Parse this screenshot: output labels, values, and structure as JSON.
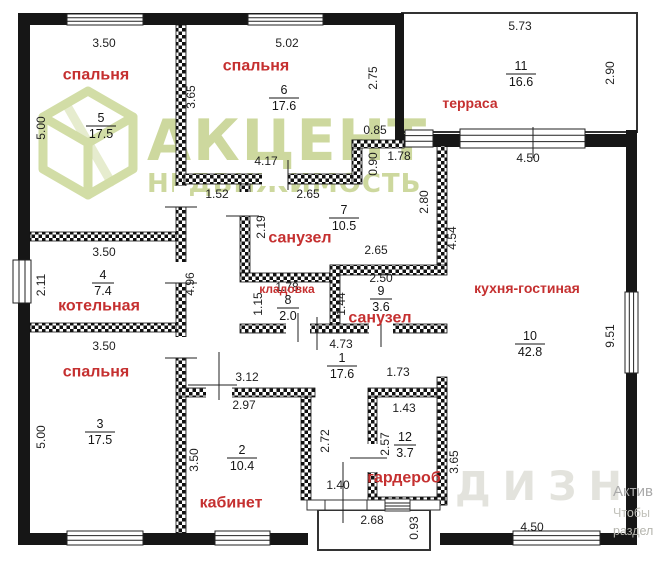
{
  "watermark": {
    "brand": "АКЦЕНТ",
    "subtitle": "НЕДВИЖИМОСТЬ",
    "faint": "ДИЗН",
    "brand_color": "#cdd89e"
  },
  "corner_note": {
    "line1": "Актив",
    "line2": "Чтобы",
    "line3": "раздел"
  },
  "accent_colors": {
    "room_label_red": "#c53030",
    "wall_black": "#161616"
  },
  "rooms": [
    {
      "n": "1",
      "a": "17.6",
      "nx": 342,
      "ny": 358
    },
    {
      "n": "2",
      "a": "10.4",
      "nx": 242,
      "ny": 450,
      "label": "кабинет",
      "lx": 231,
      "ly": 503
    },
    {
      "n": "3",
      "a": "17.5",
      "nx": 100,
      "ny": 424,
      "label": "спальня",
      "lx": 96,
      "ly": 372
    },
    {
      "n": "4",
      "a": "7.4",
      "nx": 103,
      "ny": 275,
      "label": "котельная",
      "lx": 99,
      "ly": 306
    },
    {
      "n": "5",
      "a": "17.5",
      "nx": 101,
      "ny": 118,
      "label": "спальня",
      "lx": 96,
      "ly": 75
    },
    {
      "n": "6",
      "a": "17.6",
      "nx": 284,
      "ny": 90,
      "label": "спальня",
      "lx": 256,
      "ly": 66
    },
    {
      "n": "7",
      "a": "10.5",
      "nx": 344,
      "ny": 210,
      "label": "санузел",
      "lx": 300,
      "ly": 238
    },
    {
      "n": "8",
      "a": "2.0",
      "nx": 288,
      "ny": 300,
      "label": "кладовка",
      "lx": 287,
      "ly": 289,
      "fs": 12
    },
    {
      "n": "9",
      "a": "3.6",
      "nx": 381,
      "ny": 291,
      "label": "санузел",
      "lx": 380,
      "ly": 318
    },
    {
      "n": "10",
      "a": "42.8",
      "nx": 530,
      "ny": 336,
      "label": "кухня-гостиная",
      "lx": 527,
      "ly": 288,
      "fs": 14
    },
    {
      "n": "11",
      "a": "16.6",
      "nx": 521,
      "ny": 66,
      "label": "терраса",
      "lx": 470,
      "ly": 103,
      "fs": 14
    },
    {
      "n": "12",
      "a": "3.7",
      "nx": 405,
      "ny": 437,
      "label": "гардероб",
      "lx": 404,
      "ly": 478
    }
  ],
  "dimensions": [
    {
      "t": "3.50",
      "x": 104,
      "y": 43
    },
    {
      "t": "5.02",
      "x": 287,
      "y": 43
    },
    {
      "t": "5.73",
      "x": 520,
      "y": 26
    },
    {
      "t": "2.75",
      "x": 373,
      "y": 78,
      "r": 1
    },
    {
      "t": "2.90",
      "x": 610,
      "y": 73,
      "r": 1
    },
    {
      "t": "3.65",
      "x": 191,
      "y": 97,
      "r": 1
    },
    {
      "t": "5.00",
      "x": 41,
      "y": 128,
      "r": 1
    },
    {
      "t": "0.85",
      "x": 375,
      "y": 130
    },
    {
      "t": "4.17",
      "x": 266,
      "y": 161
    },
    {
      "t": "1.78",
      "x": 399,
      "y": 156
    },
    {
      "t": "0.90",
      "x": 373,
      "y": 164,
      "r": 1
    },
    {
      "t": "4.50",
      "x": 528,
      "y": 158
    },
    {
      "t": "1.52",
      "x": 217,
      "y": 194
    },
    {
      "t": "2.65",
      "x": 308,
      "y": 194
    },
    {
      "t": "2.80",
      "x": 424,
      "y": 202,
      "r": 1
    },
    {
      "t": "2.19",
      "x": 261,
      "y": 227,
      "r": 1
    },
    {
      "t": "4.54",
      "x": 452,
      "y": 238,
      "r": 1
    },
    {
      "t": "2.65",
      "x": 376,
      "y": 250
    },
    {
      "t": "3.50",
      "x": 104,
      "y": 252
    },
    {
      "t": "2.50",
      "x": 381,
      "y": 278
    },
    {
      "t": "2.11",
      "x": 41,
      "y": 285,
      "r": 1
    },
    {
      "t": "4.96",
      "x": 190,
      "y": 284,
      "r": 1
    },
    {
      "t": "1.78",
      "x": 287,
      "y": 287
    },
    {
      "t": "1.15",
      "x": 258,
      "y": 304,
      "r": 1
    },
    {
      "t": "1.44",
      "x": 341,
      "y": 304,
      "r": 1
    },
    {
      "t": "9.51",
      "x": 610,
      "y": 336,
      "r": 1
    },
    {
      "t": "3.50",
      "x": 104,
      "y": 346
    },
    {
      "t": "4.73",
      "x": 341,
      "y": 344
    },
    {
      "t": "1.73",
      "x": 398,
      "y": 372
    },
    {
      "t": "3.12",
      "x": 247,
      "y": 377
    },
    {
      "t": "2.97",
      "x": 244,
      "y": 405
    },
    {
      "t": "1.43",
      "x": 404,
      "y": 408
    },
    {
      "t": "5.00",
      "x": 41,
      "y": 437,
      "r": 1
    },
    {
      "t": "3.50",
      "x": 194,
      "y": 460,
      "r": 1
    },
    {
      "t": "2.72",
      "x": 325,
      "y": 441,
      "r": 1
    },
    {
      "t": "2.57",
      "x": 385,
      "y": 444,
      "r": 1
    },
    {
      "t": "3.65",
      "x": 454,
      "y": 462,
      "r": 1
    },
    {
      "t": "1.40",
      "x": 338,
      "y": 485
    },
    {
      "t": "2.68",
      "x": 372,
      "y": 520
    },
    {
      "t": "0.93",
      "x": 414,
      "y": 528,
      "r": 1
    },
    {
      "t": "4.50",
      "x": 532,
      "y": 527
    }
  ]
}
